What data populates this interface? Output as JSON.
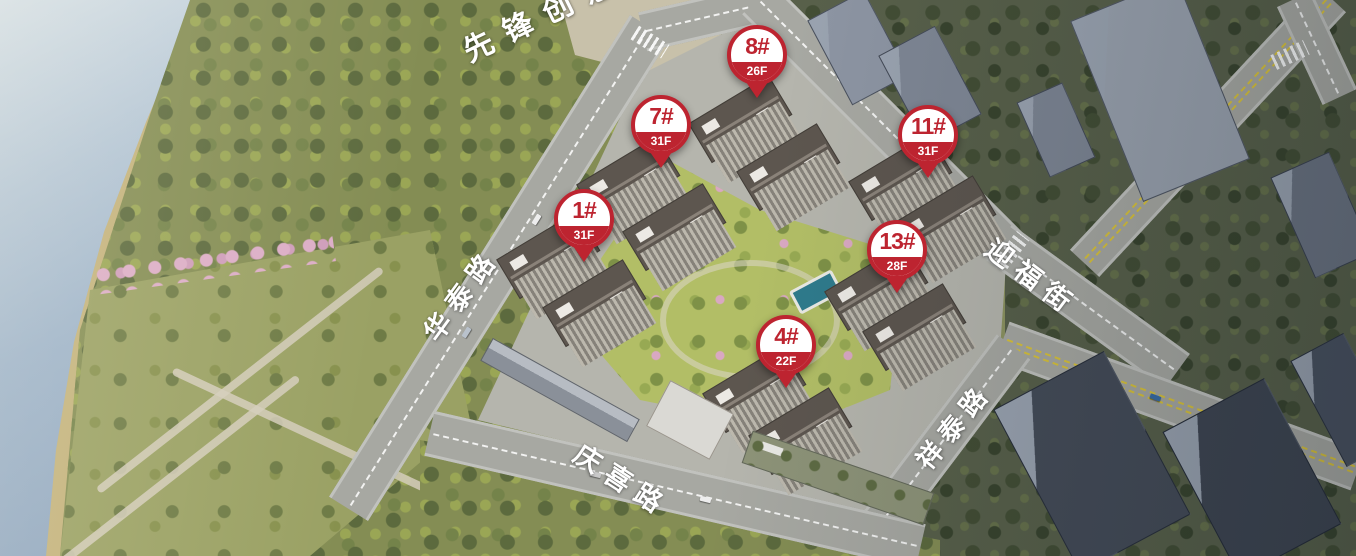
{
  "labels": {
    "area_top": "先锋创意",
    "roads": [
      "华泰路",
      "迎福街",
      "祥泰路",
      "庆喜路"
    ]
  },
  "pins": [
    {
      "number": "1#",
      "floors": "31F"
    },
    {
      "number": "7#",
      "floors": "31F"
    },
    {
      "number": "11#",
      "floors": "31F"
    },
    {
      "number": "13#",
      "floors": "28F"
    },
    {
      "number": "8#",
      "floors": "26F"
    },
    {
      "number": "4#",
      "floors": "22F"
    }
  ],
  "colors": {
    "pin_red": "#bd2430",
    "pin_text": "#ffffff",
    "label_text": "#ffffff",
    "water": "#a9bdd1",
    "road_gray": "#a7a8a2",
    "lane_yellow": "#d9c33c",
    "park_green": "#848d54",
    "courtyard_green": "#b2be66",
    "city_dark": "#4a5260",
    "pool_blue": "#2f7b8c"
  }
}
